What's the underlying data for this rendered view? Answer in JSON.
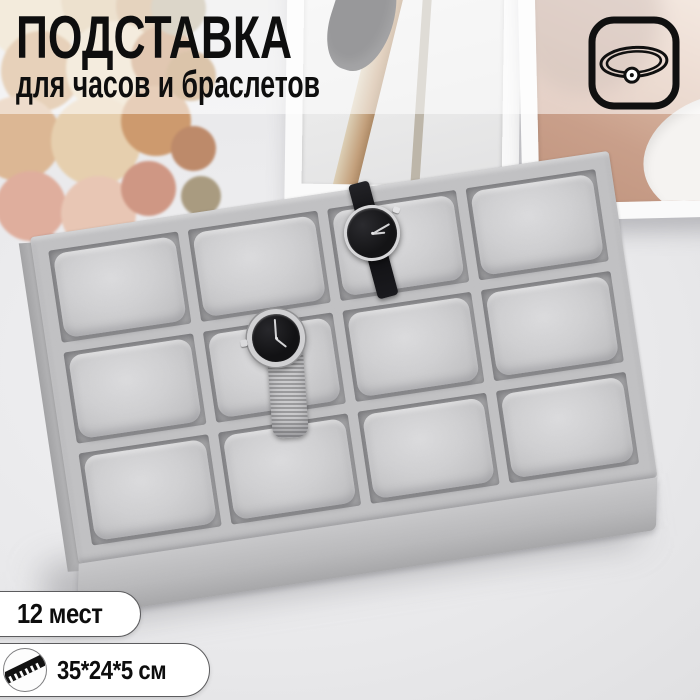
{
  "header": {
    "title": "ПОДСТАВКА",
    "subtitle": "для часов и браслетов",
    "text_color": "#0e0e0e"
  },
  "badges": {
    "capacity": "12 мест",
    "dimensions": "35*24*5 см",
    "background": "#ffffff",
    "border_color": "#5c5c5e"
  },
  "icons": {
    "bracelet": "bracelet-in-rounded-square",
    "ruler": "diagonal-ruler"
  },
  "tray": {
    "rows": 3,
    "cols": 4,
    "slot_count": 12,
    "velvet_color": "#c1c1c3",
    "cushion_color": "#d0d0d2",
    "watches": [
      {
        "id": "watch-black-leather",
        "slot_row": 1,
        "slot_col": 3,
        "dial_color": "#141416",
        "case_color": "#d7d7d9",
        "strap": "black leather"
      },
      {
        "id": "watch-silver-mesh",
        "slot_row": 2,
        "slot_col": 2,
        "dial_color": "#121214",
        "case_color": "#d0d0d2",
        "strap": "silver mesh"
      }
    ]
  },
  "scene": {
    "picture_frames": 2,
    "flowers": "dried bouquet top-left",
    "surface": "white table"
  }
}
